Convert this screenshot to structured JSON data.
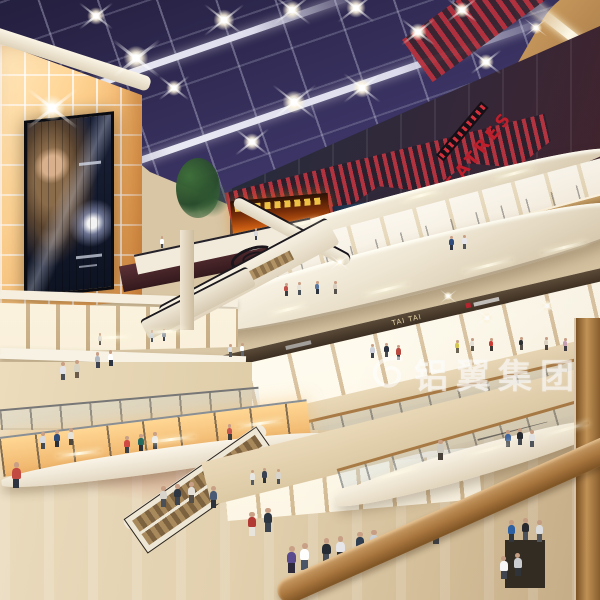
{
  "scene": {
    "type": "architectural-rendering",
    "setting": "multi-level shopping mall atrium interior at night with glass skylight roof, crisscrossing escalators, curved balconies and glowing amber panel walls",
    "signs": {
      "theatres_label": "THEATRES",
      "tai_tai_label": "TAI TAI"
    },
    "watermark": {
      "text": "铝翼集团"
    },
    "billboard": {
      "subject": "backlit cosmetics advertisement with model and jewel"
    },
    "led_screen": {
      "subject": "fiery cinema trailer screen"
    },
    "palette": {
      "sky": "#3c3566",
      "accent_red": "#b5242f",
      "cream": "#f1eadb",
      "wood": "#b3854f",
      "panel_glow": "#ffd494",
      "floor": "#e3d2b2"
    },
    "lights": [
      {
        "x": 52,
        "y": 108,
        "s": 30
      },
      {
        "x": 136,
        "y": 58,
        "s": 28
      },
      {
        "x": 224,
        "y": 20,
        "s": 24
      },
      {
        "x": 292,
        "y": 10,
        "s": 22
      },
      {
        "x": 356,
        "y": 8,
        "s": 22
      },
      {
        "x": 294,
        "y": 102,
        "s": 26
      },
      {
        "x": 362,
        "y": 88,
        "s": 22
      },
      {
        "x": 252,
        "y": 142,
        "s": 20
      },
      {
        "x": 418,
        "y": 32,
        "s": 20
      },
      {
        "x": 462,
        "y": 10,
        "s": 18
      },
      {
        "x": 486,
        "y": 62,
        "s": 18
      },
      {
        "x": 174,
        "y": 88,
        "s": 18
      },
      {
        "x": 96,
        "y": 16,
        "s": 20
      },
      {
        "x": 536,
        "y": 28,
        "s": 14
      }
    ],
    "sparkles": [
      {
        "x": 487,
        "y": 318,
        "s": 14
      },
      {
        "x": 547,
        "y": 306,
        "s": 14
      },
      {
        "x": 340,
        "y": 262,
        "s": 12
      },
      {
        "x": 448,
        "y": 296,
        "s": 10
      }
    ],
    "streaks": [
      {
        "x": 284,
        "y": 222,
        "w": 36,
        "a": -15
      },
      {
        "x": 400,
        "y": 194,
        "w": 42,
        "a": -15
      },
      {
        "x": 492,
        "y": 172,
        "w": 44,
        "a": -15
      },
      {
        "x": 268,
        "y": 308,
        "w": 40,
        "a": -14
      },
      {
        "x": 362,
        "y": 288,
        "w": 48,
        "a": -14
      },
      {
        "x": 462,
        "y": 264,
        "w": 52,
        "a": -14
      },
      {
        "x": 540,
        "y": 246,
        "w": 48,
        "a": -14
      },
      {
        "x": 92,
        "y": 336,
        "w": 40,
        "a": -3
      },
      {
        "x": 146,
        "y": 330,
        "w": 40,
        "a": -4
      },
      {
        "x": 56,
        "y": 452,
        "w": 46,
        "a": -7
      },
      {
        "x": 146,
        "y": 438,
        "w": 50,
        "a": -7
      },
      {
        "x": 236,
        "y": 422,
        "w": 48,
        "a": -8
      },
      {
        "x": 372,
        "y": 472,
        "w": 50,
        "a": -16
      },
      {
        "x": 462,
        "y": 448,
        "w": 54,
        "a": -16
      },
      {
        "x": 540,
        "y": 428,
        "w": 50,
        "a": -16
      }
    ],
    "people": [
      {
        "x": 160,
        "y": 236,
        "h": 12,
        "s": "#ffffff",
        "p": "#444a55"
      },
      {
        "x": 254,
        "y": 228,
        "h": 12,
        "s": "#d9d9de",
        "p": "#3a4050"
      },
      {
        "x": 449,
        "y": 236,
        "h": 14,
        "s": "#2e4e80",
        "p": "#2e3542"
      },
      {
        "x": 462,
        "y": 235,
        "h": 14,
        "s": "#e8e8ee",
        "p": "#50565f"
      },
      {
        "x": 284,
        "y": 283,
        "h": 13,
        "s": "#c05048",
        "p": "#3a3f48"
      },
      {
        "x": 297,
        "y": 282,
        "h": 13,
        "s": "#e6e2d8",
        "p": "#4a5058"
      },
      {
        "x": 315,
        "y": 281,
        "h": 13,
        "s": "#5a77a0",
        "p": "#2e343e"
      },
      {
        "x": 333,
        "y": 281,
        "h": 13,
        "s": "#d8cfc0",
        "p": "#56504a"
      },
      {
        "x": 370,
        "y": 344,
        "h": 14,
        "s": "#cfd2d8",
        "p": "#3e444e"
      },
      {
        "x": 384,
        "y": 343,
        "h": 14,
        "s": "#2c3440",
        "p": "#454b55"
      },
      {
        "x": 396,
        "y": 345,
        "h": 15,
        "s": "#b84a42",
        "p": "#32363e"
      },
      {
        "x": 455,
        "y": 340,
        "h": 13,
        "s": "#d8c84a",
        "p": "#6b6454"
      },
      {
        "x": 470,
        "y": 338,
        "h": 13,
        "s": "#e8e4da",
        "p": "#5a554c"
      },
      {
        "x": 489,
        "y": 338,
        "h": 13,
        "s": "#cf3a33",
        "p": "#3a3630"
      },
      {
        "x": 519,
        "y": 337,
        "h": 13,
        "s": "#2a2e33",
        "p": "#55504a"
      },
      {
        "x": 544,
        "y": 337,
        "h": 13,
        "s": "#e0d8c8",
        "p": "#4c463e"
      },
      {
        "x": 563,
        "y": 338,
        "h": 13,
        "s": "#caa4b8",
        "p": "#3e3a42"
      },
      {
        "x": 227,
        "y": 424,
        "h": 16,
        "s": "#c7554f",
        "p": "#3d3d3d"
      },
      {
        "x": 60,
        "y": 362,
        "h": 18,
        "s": "#e4e4e8",
        "p": "#4a4f58"
      },
      {
        "x": 74,
        "y": 360,
        "h": 18,
        "s": "#d8d2c2",
        "p": "#6b5b4a"
      },
      {
        "x": 95,
        "y": 352,
        "h": 16,
        "s": "#b0b8c2",
        "p": "#3c4250"
      },
      {
        "x": 108,
        "y": 350,
        "h": 16,
        "s": "#ffffff",
        "p": "#2e3542"
      },
      {
        "x": 228,
        "y": 344,
        "h": 13,
        "s": "#dfe3e8",
        "p": "#555b62"
      },
      {
        "x": 240,
        "y": 343,
        "h": 13,
        "s": "#ffffff",
        "p": "#5f666e"
      },
      {
        "x": 150,
        "y": 330,
        "h": 12,
        "s": "#cdd2d8",
        "p": "#4e545c"
      },
      {
        "x": 162,
        "y": 329,
        "h": 12,
        "s": "#8a94a2",
        "p": "#3a4048"
      },
      {
        "x": 98,
        "y": 333,
        "h": 12,
        "s": "#d2cfc8",
        "p": "#55514a"
      },
      {
        "x": 40,
        "y": 432,
        "h": 17,
        "s": "#d8dade",
        "p": "#454b54"
      },
      {
        "x": 54,
        "y": 430,
        "h": 17,
        "s": "#2e4a78",
        "p": "#2a3038"
      },
      {
        "x": 68,
        "y": 428,
        "h": 17,
        "s": "#e6e2d8",
        "p": "#4e463c"
      },
      {
        "x": 124,
        "y": 436,
        "h": 17,
        "s": "#cf4a42",
        "p": "#3a3f48"
      },
      {
        "x": 138,
        "y": 434,
        "h": 17,
        "s": "#256a5e",
        "p": "#2c3138"
      },
      {
        "x": 152,
        "y": 432,
        "h": 17,
        "s": "#e8e8ec",
        "p": "#3e444e"
      },
      {
        "x": 12,
        "y": 462,
        "h": 26,
        "s": "#c14a42",
        "p": "#2e3440"
      },
      {
        "x": 160,
        "y": 486,
        "h": 21,
        "s": "#d8d4cc",
        "p": "#4a5058"
      },
      {
        "x": 174,
        "y": 484,
        "h": 21,
        "s": "#2c3540",
        "p": "#3c4450"
      },
      {
        "x": 188,
        "y": 482,
        "h": 21,
        "s": "#e4e0d8",
        "p": "#55504a"
      },
      {
        "x": 210,
        "y": 486,
        "h": 22,
        "s": "#4a5a74",
        "p": "#2c323c"
      },
      {
        "x": 250,
        "y": 470,
        "h": 15,
        "s": "#e8e6e0",
        "p": "#555b64"
      },
      {
        "x": 262,
        "y": 468,
        "h": 15,
        "s": "#3a4252",
        "p": "#2c3138"
      },
      {
        "x": 276,
        "y": 469,
        "h": 15,
        "s": "#d8d4cc",
        "p": "#4a5058"
      },
      {
        "x": 248,
        "y": 512,
        "h": 24,
        "s": "#b23a34",
        "p": "#e8e4dc"
      },
      {
        "x": 264,
        "y": 508,
        "h": 24,
        "s": "#2c3540",
        "p": "#3c4450"
      },
      {
        "x": 287,
        "y": 546,
        "h": 27,
        "s": "#5a4a8e",
        "p": "#2e2a3a"
      },
      {
        "x": 300,
        "y": 543,
        "h": 27,
        "s": "#ffffff",
        "p": "#4a5568"
      },
      {
        "x": 322,
        "y": 538,
        "h": 25,
        "s": "#252b33",
        "p": "#454d58"
      },
      {
        "x": 336,
        "y": 536,
        "h": 25,
        "s": "#e8e8ec",
        "p": "#2c323c"
      },
      {
        "x": 356,
        "y": 532,
        "h": 24,
        "s": "#2e3e52",
        "p": "#23282f"
      },
      {
        "x": 370,
        "y": 530,
        "h": 24,
        "s": "#cfd4da",
        "p": "#474f5a"
      },
      {
        "x": 404,
        "y": 524,
        "h": 26,
        "s": "#454c58",
        "p": "#23282e"
      },
      {
        "x": 432,
        "y": 518,
        "h": 26,
        "s": "#e4e6ea",
        "p": "#3c434e"
      },
      {
        "x": 437,
        "y": 440,
        "h": 20,
        "s": "#cfcbc2",
        "p": "#46413a"
      },
      {
        "x": 505,
        "y": 430,
        "h": 17,
        "s": "#3e66a0",
        "p": "#333a44"
      },
      {
        "x": 517,
        "y": 428,
        "h": 17,
        "s": "#23282f",
        "p": "#3e4550"
      },
      {
        "x": 529,
        "y": 430,
        "h": 17,
        "s": "#e6e8ea",
        "p": "#4e555e"
      },
      {
        "x": 508,
        "y": 520,
        "h": 22,
        "s": "#2a61a8",
        "p": "#2e353f"
      },
      {
        "x": 522,
        "y": 518,
        "h": 22,
        "s": "#23282f",
        "p": "#4a525e"
      },
      {
        "x": 536,
        "y": 520,
        "h": 22,
        "s": "#e2e4e8",
        "p": "#50575f"
      },
      {
        "x": 500,
        "y": 556,
        "h": 23,
        "s": "#ffffff",
        "p": "#3e4550"
      },
      {
        "x": 514,
        "y": 553,
        "h": 23,
        "s": "#d0d4da",
        "p": "#2c323a"
      }
    ]
  }
}
